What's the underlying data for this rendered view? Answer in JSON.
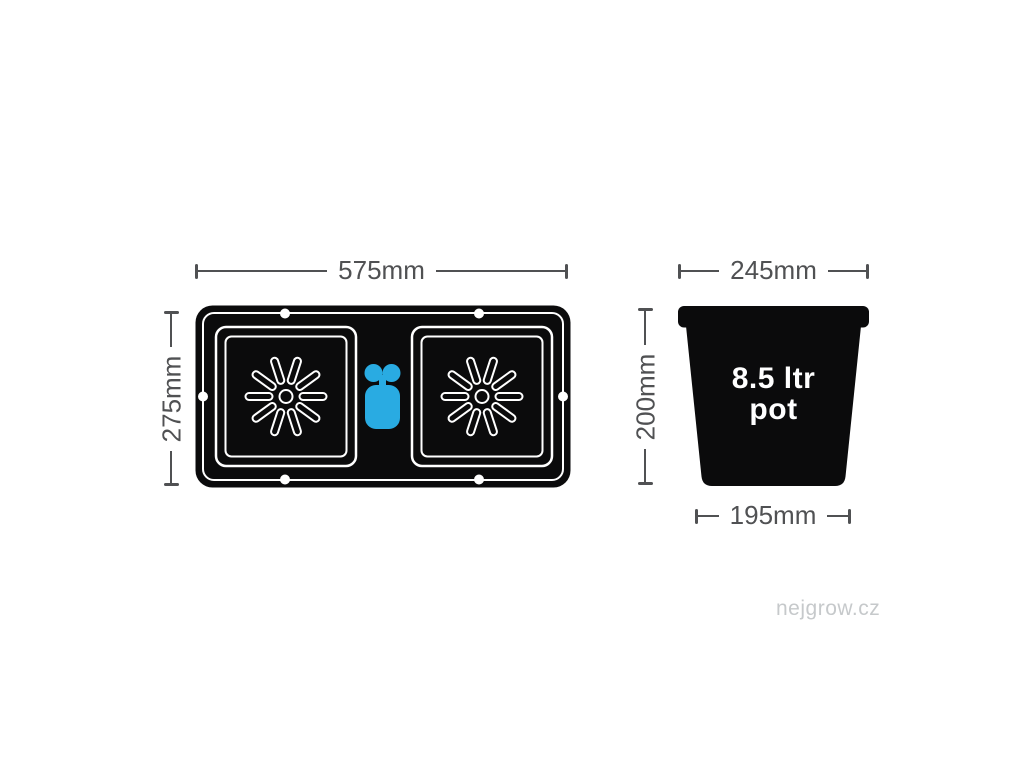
{
  "colors": {
    "ink": "#0b0b0c",
    "dim": "#505153",
    "accent-blue": "#29abe2",
    "watermark-gray": "#c6c9cb",
    "bg": "#ffffff"
  },
  "diagram": {
    "tray": {
      "width_label": "575mm",
      "depth_label": "275mm"
    },
    "pot": {
      "top_width_label": "245mm",
      "height_label": "200mm",
      "base_width_label": "195mm",
      "capacity_line1": "8.5 ltr",
      "capacity_line2": "pot"
    },
    "watermark": "nejgrow.cz"
  }
}
